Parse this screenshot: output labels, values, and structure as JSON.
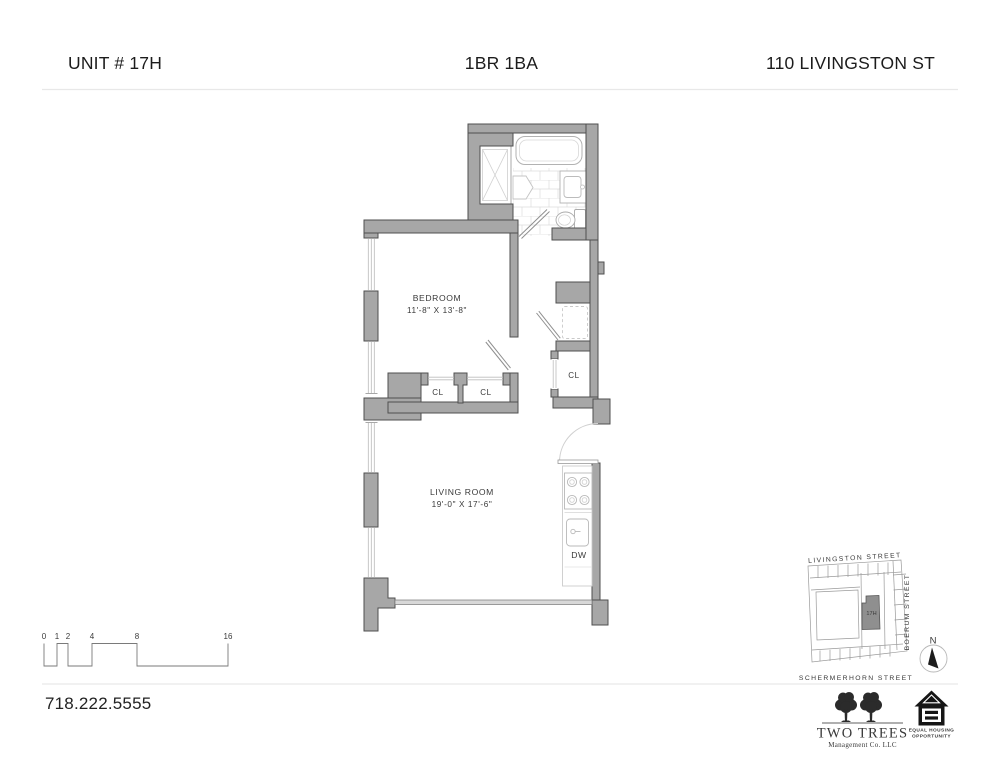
{
  "header": {
    "unit": "UNIT # 17H",
    "layout": "1BR 1BA",
    "address": "110 LIVINGSTON ST"
  },
  "floorplan": {
    "bedroom": {
      "name": "BEDROOM",
      "dims": "11'-8\" X 13'-8\""
    },
    "living": {
      "name": "LIVING ROOM",
      "dims": "19'-0\" X 17'-6\""
    },
    "closets": [
      "CL",
      "CL",
      "CL"
    ],
    "dishwasher": "DW"
  },
  "scale": {
    "ticks": [
      "0",
      "1",
      "2",
      "4",
      "8",
      "16"
    ]
  },
  "footer": {
    "phone": "718.222.5555"
  },
  "map": {
    "streets": {
      "top": "LIVINGSTON  STREET",
      "right": "BOERUM  STREET",
      "bottom": "SCHERMERHORN  STREET"
    },
    "unit": "17H",
    "north": "N"
  },
  "logos": {
    "two_trees": {
      "title": "TWO TREES",
      "subtitle": "Management Co. LLC"
    },
    "eho": {
      "line1": "EQUAL HOUSING",
      "line2": "OPPORTUNITY"
    }
  },
  "colors": {
    "wall": "#a7a7a7",
    "wall_outline": "#4f4f4f",
    "fixture_line": "#b5b5b5",
    "tile_line": "#dddddd",
    "text": "#3a3a3a",
    "map_line": "#9a9a9a",
    "unit_fill": "#8f8f8f",
    "divider": "#e6e6e6"
  }
}
